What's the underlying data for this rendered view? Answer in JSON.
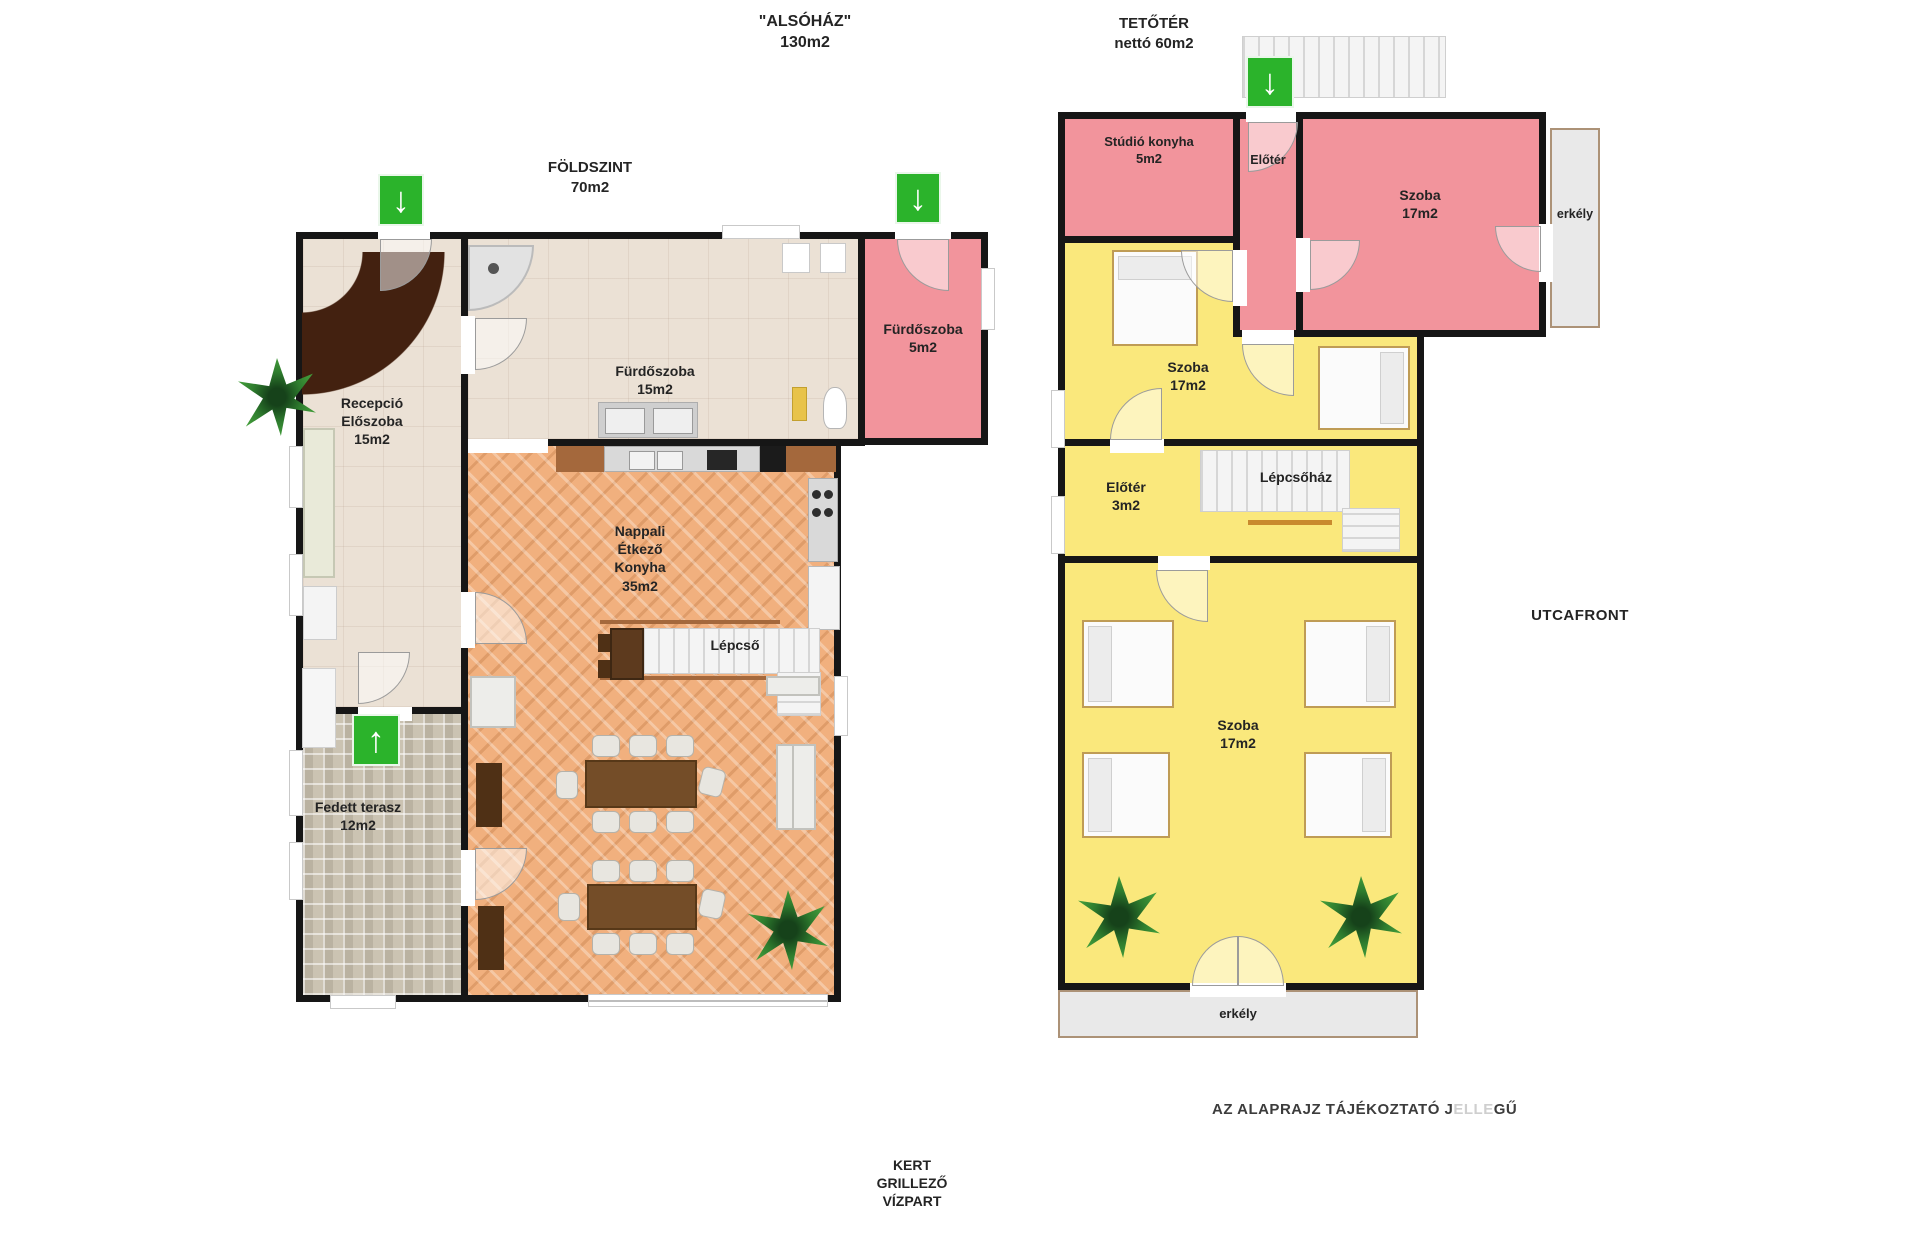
{
  "colors": {
    "wall": "#161616",
    "pink_room": "#f2949c",
    "yellow_room": "#fae87c",
    "beige_room": "#ebe1d5",
    "parquet": "#f1b07e",
    "stone_terrace": "#cbc3b2",
    "arrow_green": "#2bb32b",
    "balcony_grey": "#e9e9e9"
  },
  "icons": {
    "down_arrow": "↓",
    "up_arrow": "↑"
  },
  "titles": {
    "lower_house_line1": "\"ALSÓHÁZ\"",
    "lower_house_line2": "130m2",
    "ground_line1": "FÖLDSZINT",
    "ground_line2": "70m2",
    "attic_line1": "TETŐTÉR",
    "attic_line2": "nettó 60m2",
    "street_front": "UTCAFRONT",
    "disclaimer_part1": "AZ ALAPRAJZ TÁJÉKOZTATÓ J",
    "disclaimer_part2": "ELLE",
    "disclaimer_part3": "GŰ",
    "garden_line1": "KERT",
    "garden_line2": "GRILLEZŐ",
    "garden_line3": "VÍZPART"
  },
  "ground": {
    "reception_line1": "Recepció",
    "reception_line2": "Előszoba",
    "reception_area": "15m2",
    "bath_large_name": "Fürdőszoba",
    "bath_large_area": "15m2",
    "bath_small_name": "Fürdőszoba",
    "bath_small_area": "5m2",
    "living_line1": "Nappali",
    "living_line2": "Étkező",
    "living_line3": "Konyha",
    "living_area": "35m2",
    "stairs": "Lépcső",
    "terrace_name": "Fedett terasz",
    "terrace_area": "12m2"
  },
  "attic": {
    "studio_name": "Stúdió konyha",
    "studio_area": "5m2",
    "hall_top": "Előtér",
    "bedroom_pink_name": "Szoba",
    "bedroom_pink_area": "17m2",
    "balcony_right": "erkély",
    "bedroom_mid_name": "Szoba",
    "bedroom_mid_area": "17m2",
    "hall_mid_name": "Előtér",
    "hall_mid_area": "3m2",
    "stairwell": "Lépcsőház",
    "bedroom_bottom_name": "Szoba",
    "bedroom_bottom_area": "17m2",
    "balcony_bottom": "erkély"
  }
}
